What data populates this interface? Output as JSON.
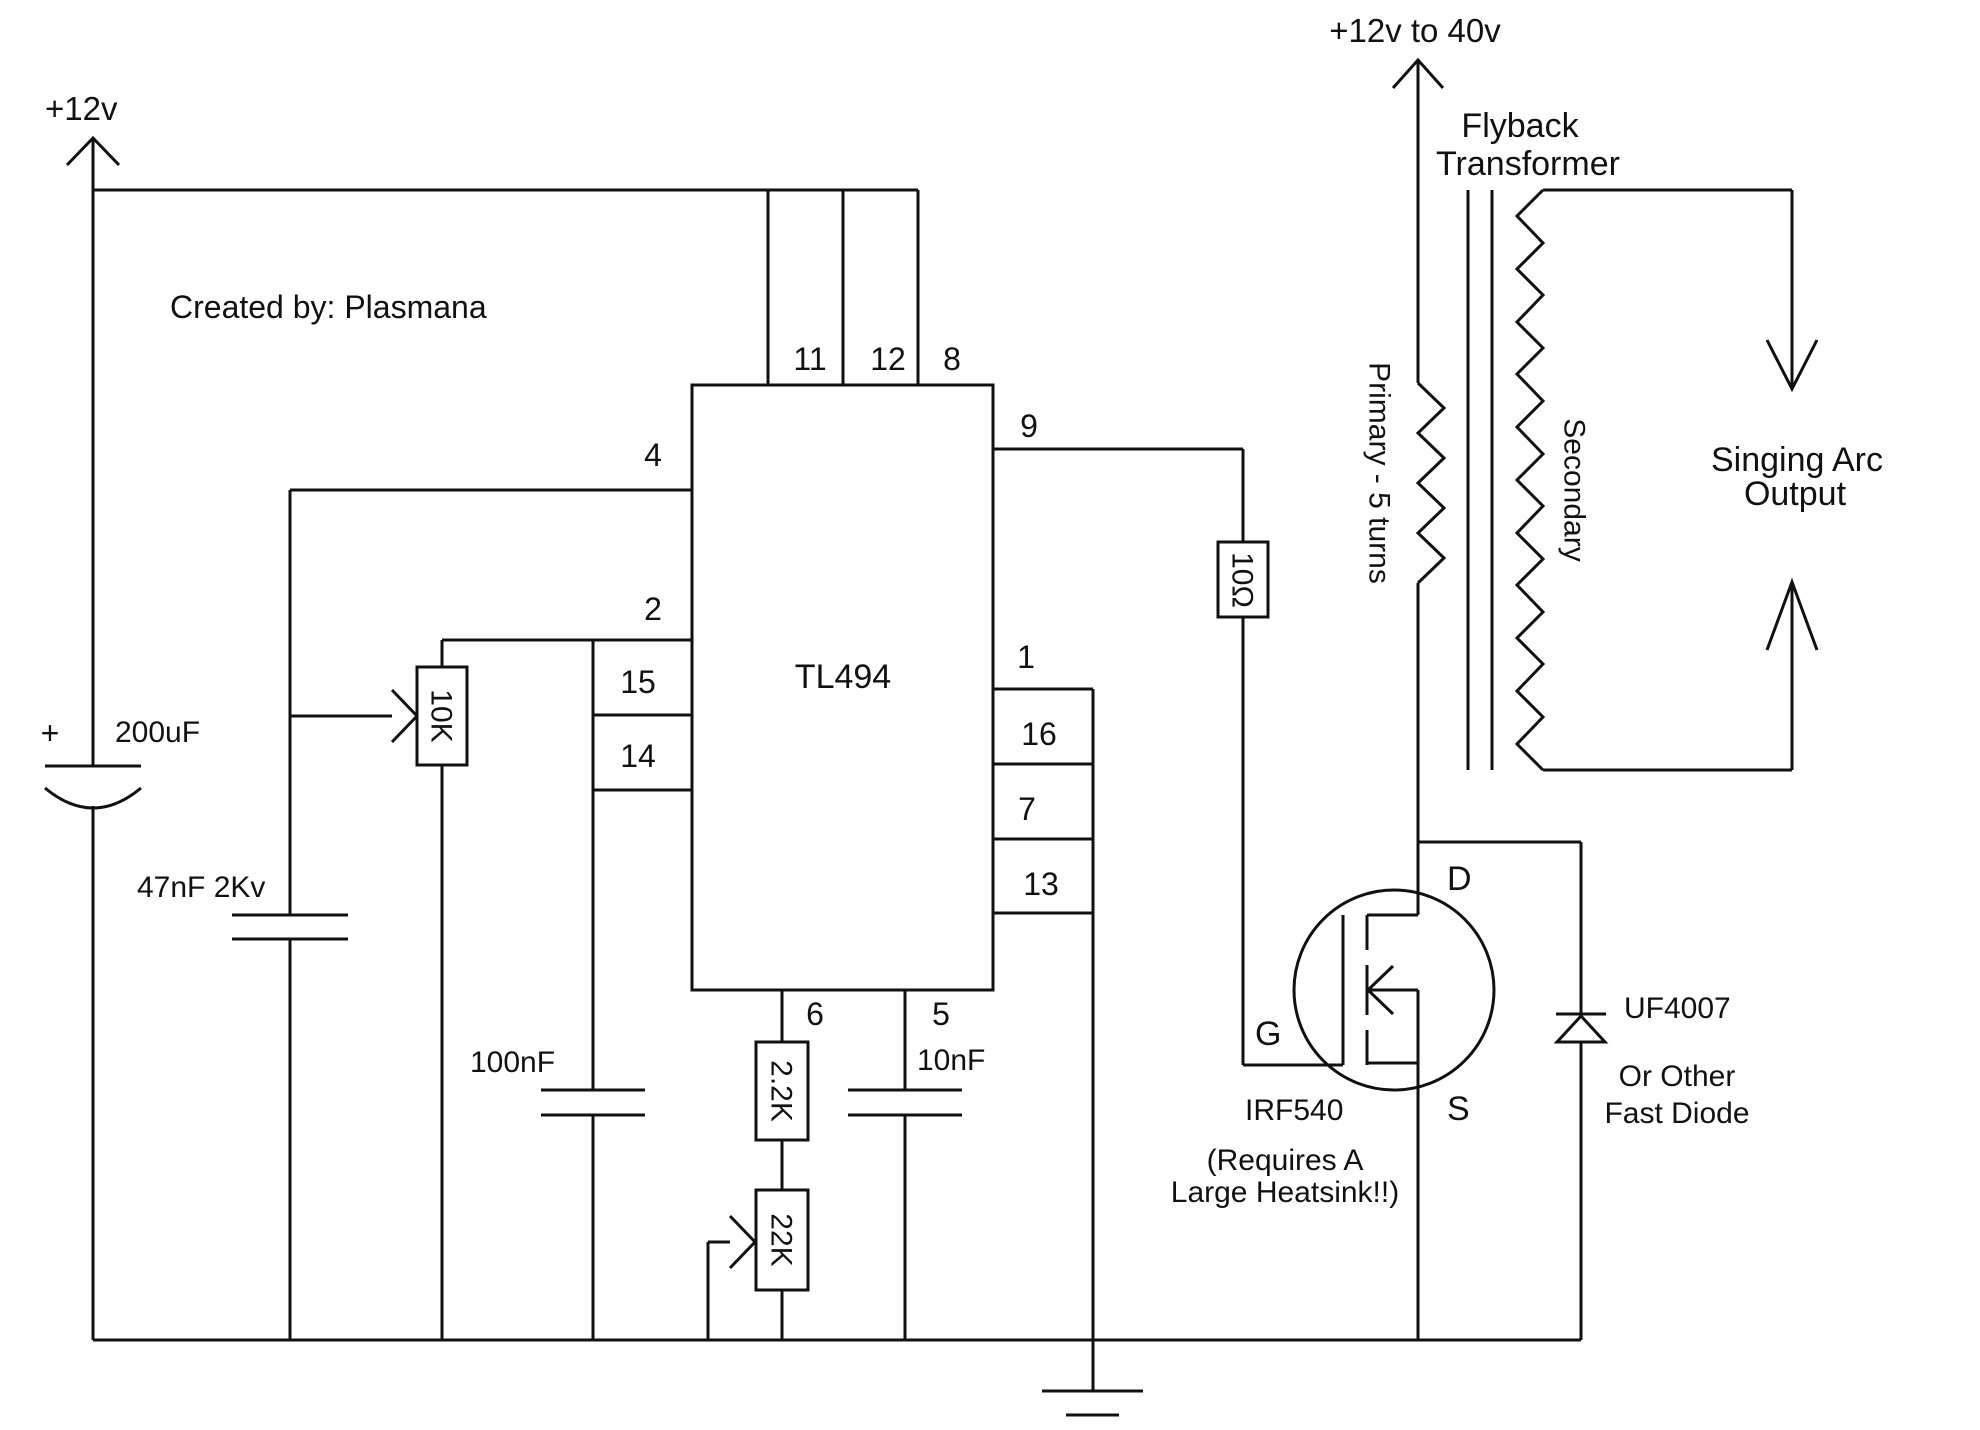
{
  "credit": "Created by: Plasmana",
  "supply": {
    "left": "+12v",
    "right": "+12v to 40v"
  },
  "ic": {
    "name": "TL494",
    "pin11": "11",
    "pin12": "12",
    "pin8": "8",
    "pin4": "4",
    "pin2": "2",
    "pin15": "15",
    "pin14": "14",
    "pin9": "9",
    "pin1": "1",
    "pin16": "16",
    "pin7": "7",
    "pin13": "13",
    "pin6": "6",
    "pin5": "5"
  },
  "capacitors": {
    "bulk": {
      "value": "200uF",
      "polarity": "+"
    },
    "snubber": {
      "value": "47nF 2Kv"
    },
    "feedback": {
      "value": "100nF"
    },
    "timing": {
      "value": "10nF"
    }
  },
  "resistors": {
    "gate": {
      "value": "10Ω"
    },
    "timing": {
      "value": "2.2K"
    },
    "feedback_pot": {
      "value": "10K"
    },
    "frequency_pot": {
      "value": "22K"
    }
  },
  "mosfet": {
    "part": "IRF540",
    "pin_d": "D",
    "pin_g": "G",
    "pin_s": "S",
    "note1": "(Requires A",
    "note2": "Large Heatsink!!)"
  },
  "diode": {
    "part": "UF4007",
    "note1": "Or Other",
    "note2": "Fast Diode"
  },
  "transformer": {
    "title1": "Flyback",
    "title2": "Transformer",
    "primary": "Primary - 5 turns",
    "secondary": "Secondary"
  },
  "output": {
    "label1": "Singing Arc",
    "label2": "Output"
  }
}
